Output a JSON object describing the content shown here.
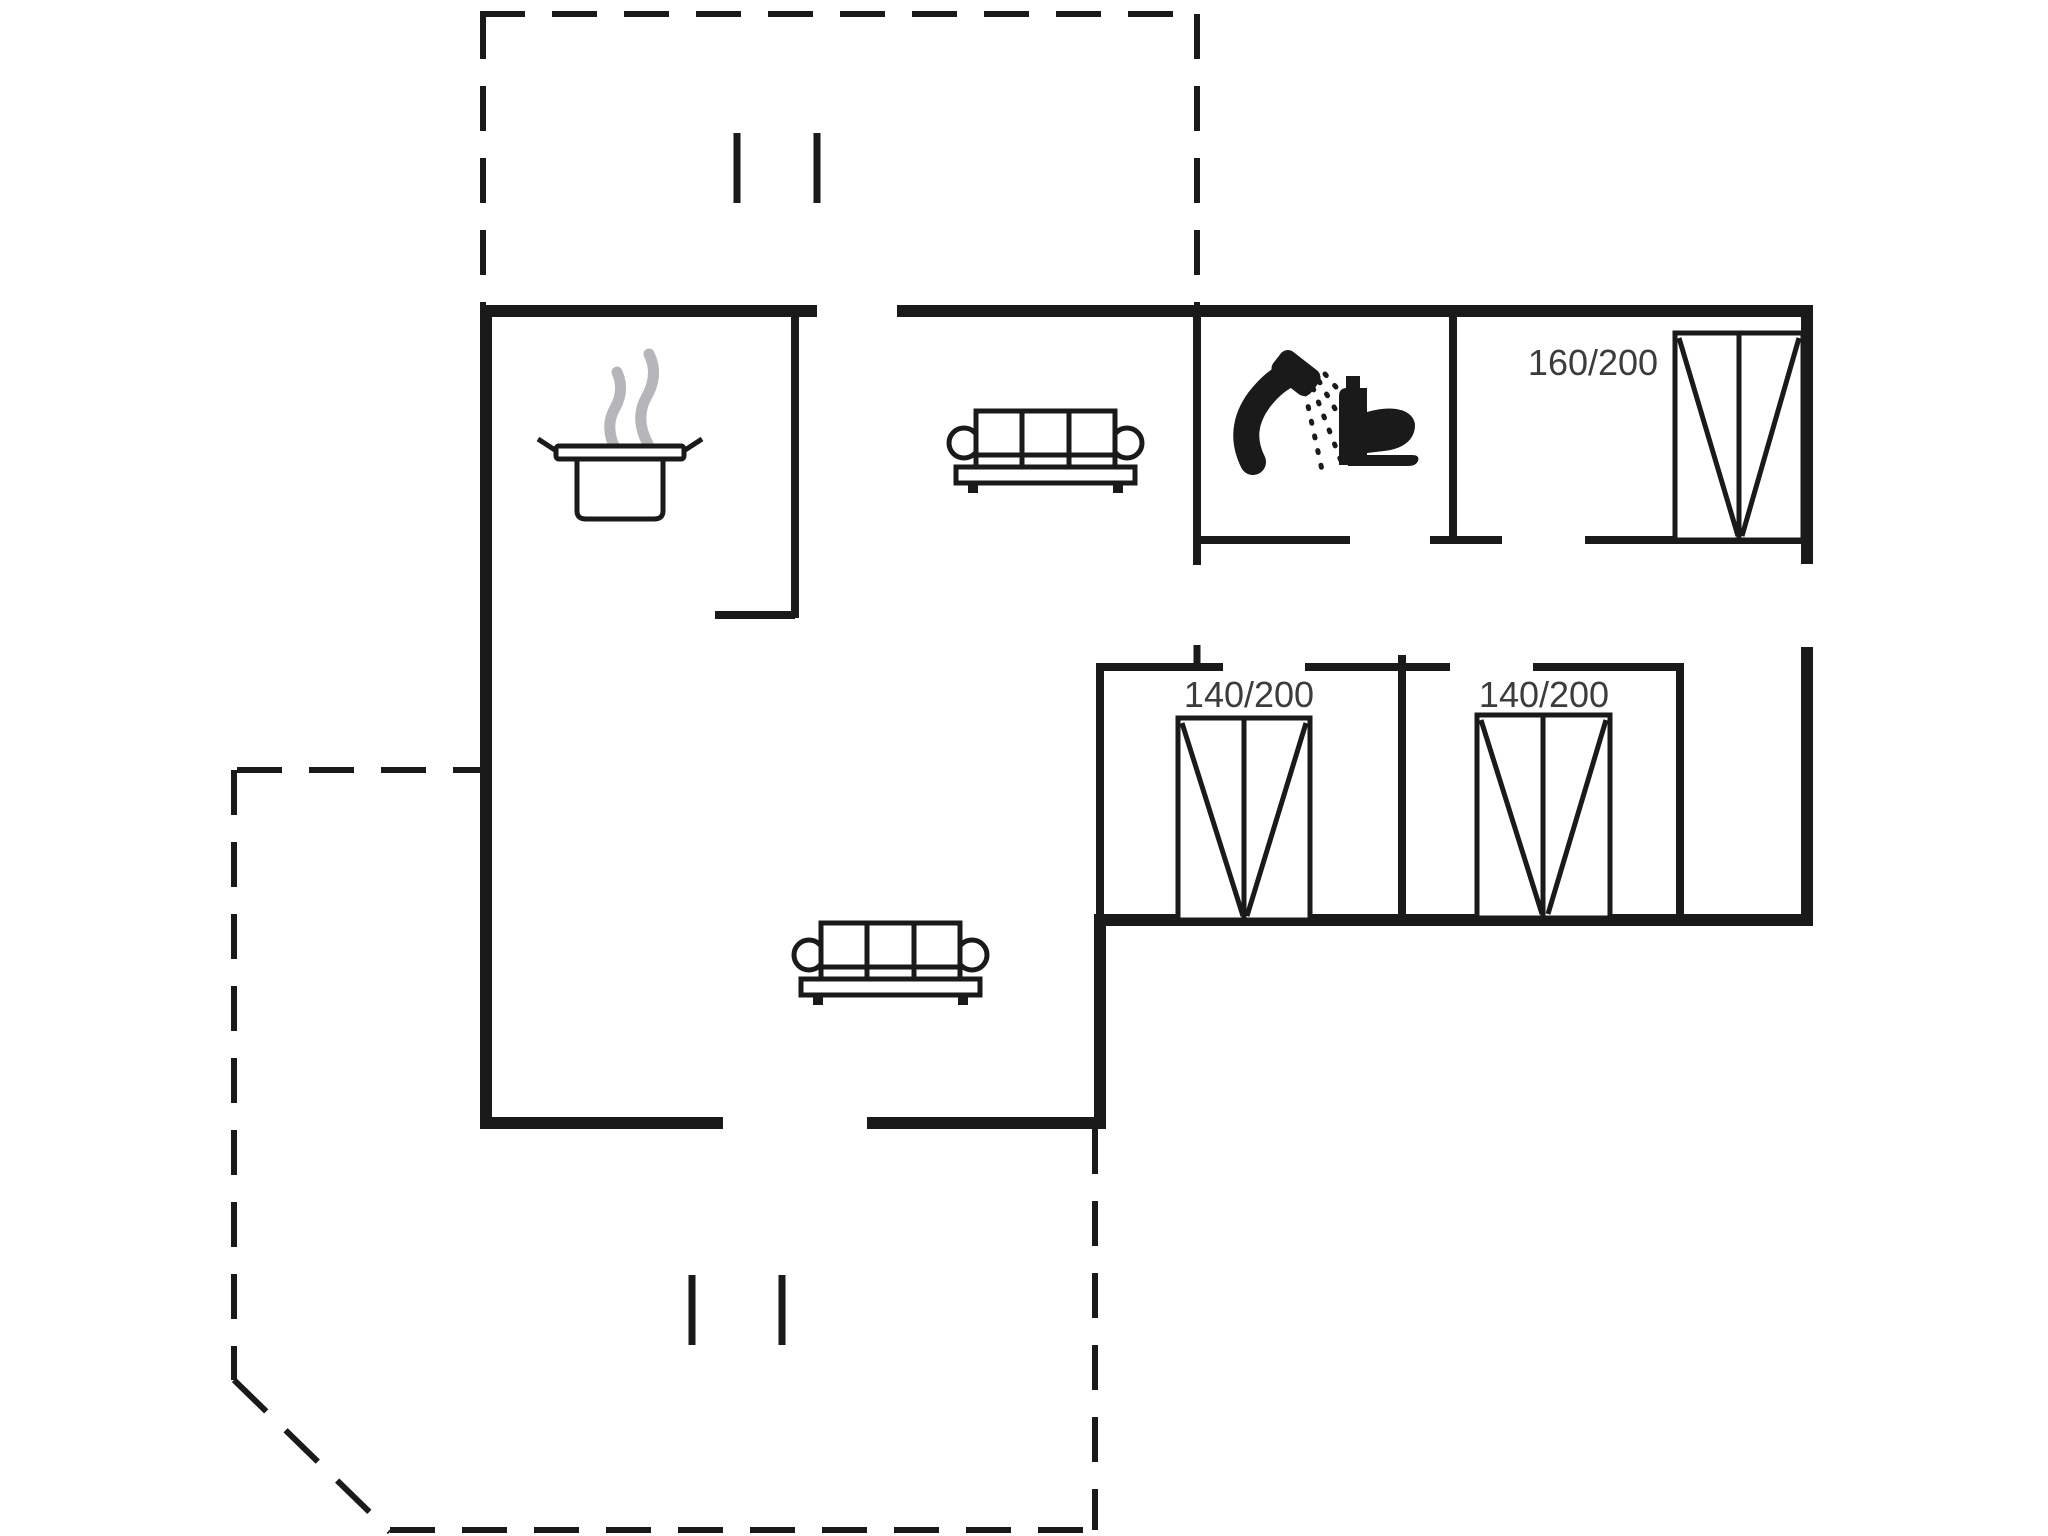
{
  "plan": {
    "type": "holiday-house-floor-plan",
    "rooms": {
      "bedroom_top_right": {
        "bed_label": "160/200"
      },
      "bedroom_bottom_left": {
        "bed_label": "140/200"
      },
      "bedroom_bottom_right": {
        "bed_label": "140/200"
      }
    },
    "icons": {
      "kitchen": "cooking-pot-with-steam-icon",
      "living_room": [
        "sofa-icon",
        "sofa-icon"
      ],
      "bathroom": [
        "hand-shower-icon",
        "toilet-icon"
      ],
      "bedrooms": [
        "double-bed-icon",
        "double-bed-icon",
        "double-bed-icon"
      ],
      "terraces": [
        "dashed-terrace-outline-top",
        "dashed-terrace-outline-bottom"
      ]
    },
    "colors": {
      "wall": "#1a1a1a",
      "steam": "#b5b5ba",
      "label": "#3c3c3c",
      "background": "#ffffff"
    }
  }
}
